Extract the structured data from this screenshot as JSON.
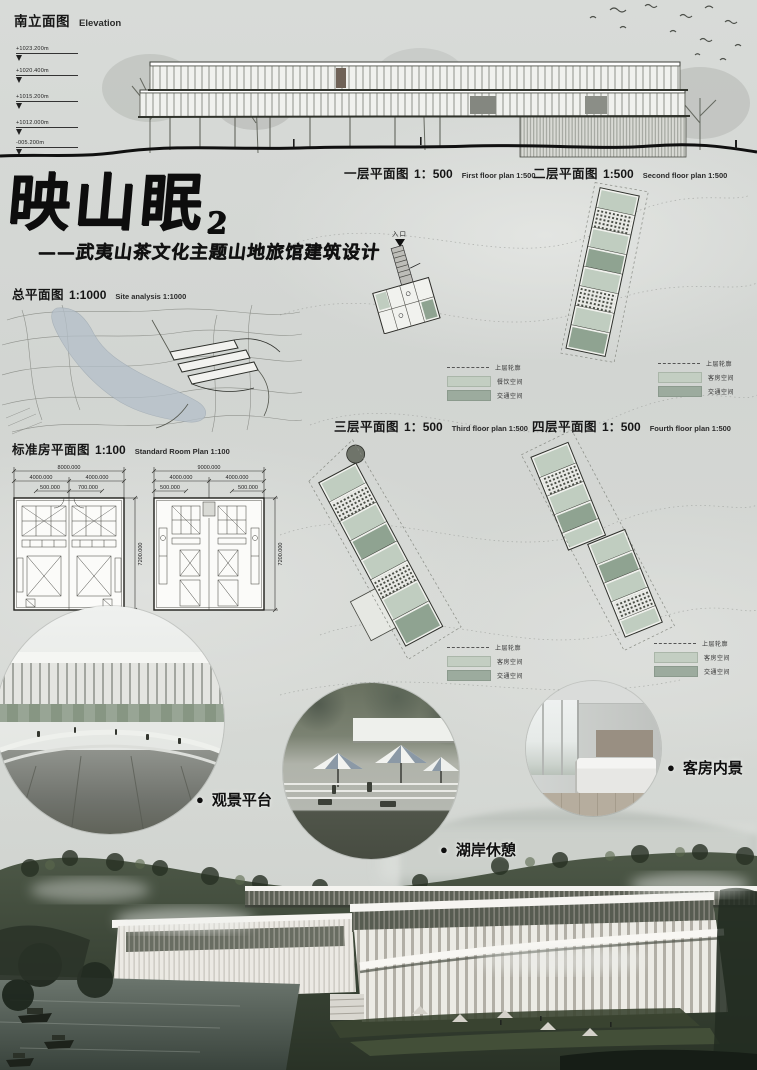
{
  "elevation": {
    "title_zh": "南立面图",
    "title_en": "Elevation",
    "markers": [
      "+1023.200m",
      "+1020.400m",
      "+1015.200m",
      "+1012.000m",
      "-005.200m"
    ]
  },
  "title_block": {
    "title": "映山眠",
    "number": "2",
    "subtitle": "——武夷山茶文化主题山地旅馆建筑设计"
  },
  "site_plan": {
    "label_zh": "总平面图",
    "scale": "1:1000",
    "label_en": "Site analysis 1:1000"
  },
  "floor_plans": {
    "first": {
      "label_zh": "一层平面图",
      "scale": "1：500",
      "label_en": "First floor plan 1:500",
      "entrance": "入口"
    },
    "second": {
      "label_zh": "二层平面图",
      "scale": "1:500",
      "label_en": "Second floor plan 1:500"
    },
    "third": {
      "label_zh": "三层平面图",
      "scale": "1：500",
      "label_en": "Third floor plan 1:500"
    },
    "fourth": {
      "label_zh": "四层平面图",
      "scale": "1：500",
      "label_en": "Fourth floor plan 1:500"
    }
  },
  "legends": {
    "first": {
      "dashed": "上层轮廓",
      "light": "餐饮空间",
      "dark": "交通空间"
    },
    "second": {
      "dashed": "上层轮廓",
      "light": "客房空间",
      "dark": "交通空间"
    },
    "third": {
      "dashed": "上层轮廓",
      "light": "客房空间",
      "dark": "交通空间"
    },
    "fourth": {
      "dashed": "上层轮廓",
      "light": "客房空间",
      "dark": "交通空间"
    }
  },
  "standard_room": {
    "label_zh": "标准房平面图",
    "scale": "1:100",
    "label_en": "Standard Room Plan 1:100",
    "left": {
      "total": "8000.000",
      "a": "4000.000",
      "b": "4000.000",
      "c": "500.000",
      "d": "700.000",
      "h": "7200.000"
    },
    "right": {
      "total": "9000.000",
      "a": "4000.000",
      "b": "4000.000",
      "c": "500.000",
      "d": "500.000",
      "h": "7200.000"
    }
  },
  "renders": {
    "bullet": "●",
    "platform": {
      "label": "观景平台"
    },
    "lakeside": {
      "label": "湖岸休憩"
    },
    "room": {
      "label": "客房内景"
    }
  },
  "colors": {
    "legend_light": "#c3cec2",
    "legend_dark": "#9cab9e",
    "plan_green_light": "#c0cdc0",
    "plan_green_dark": "#8fa391",
    "ink": "#141414"
  }
}
